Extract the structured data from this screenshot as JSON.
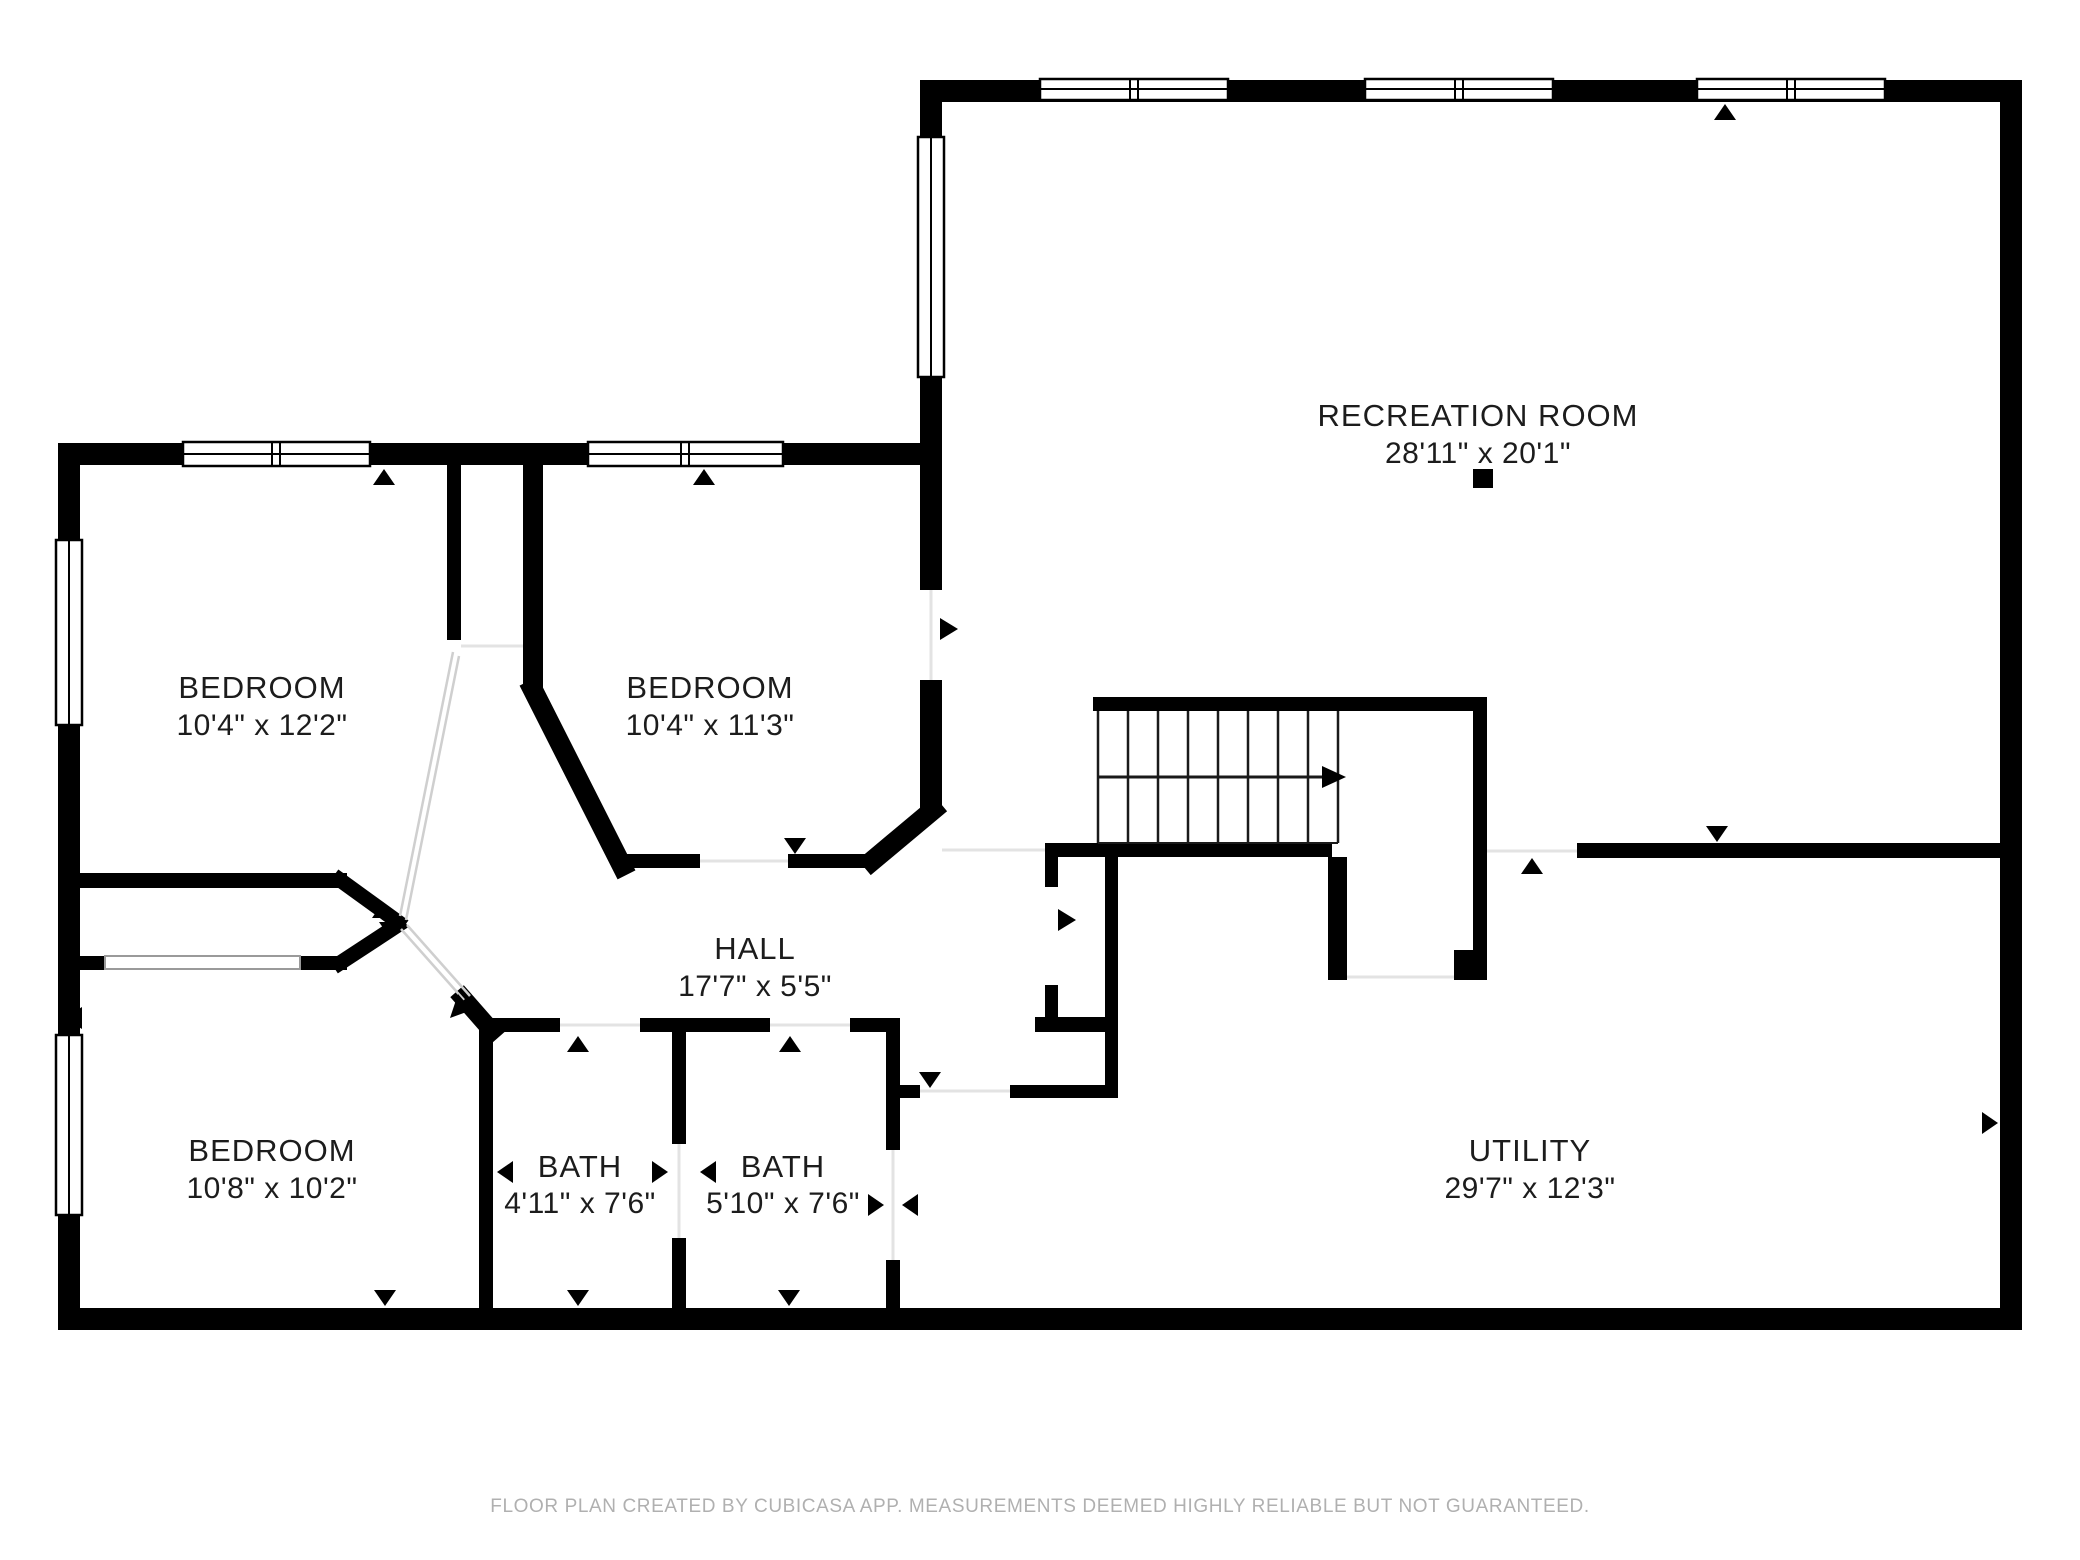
{
  "page": {
    "background": "#ffffff"
  },
  "plan": {
    "wall_color": "#000000",
    "text_color": "#1c1c1c",
    "rooms": [
      {
        "id": "recreation-room",
        "name": "RECREATION ROOM",
        "dimensions": "28'11\" x 20'1\""
      },
      {
        "id": "bedroom-top-left",
        "name": "BEDROOM",
        "dimensions": "10'4\" x 12'2\""
      },
      {
        "id": "bedroom-top-center",
        "name": "BEDROOM",
        "dimensions": "10'4\" x 11'3\""
      },
      {
        "id": "hall",
        "name": "HALL",
        "dimensions": "17'7\" x 5'5\""
      },
      {
        "id": "bedroom-bottom-left",
        "name": "BEDROOM",
        "dimensions": "10'8\" x 10'2\""
      },
      {
        "id": "bath-left",
        "name": "BATH",
        "dimensions": "4'11\" x 7'6\""
      },
      {
        "id": "bath-right",
        "name": "BATH",
        "dimensions": "5'10\" x 7'6\""
      },
      {
        "id": "utility",
        "name": "UTILITY",
        "dimensions": "29'7\" x 12'3\""
      }
    ],
    "stairs": {
      "direction": "right",
      "tread_count": 8
    }
  },
  "footer": {
    "text": "FLOOR PLAN CREATED BY CUBICASA APP. MEASUREMENTS DEEMED HIGHLY RELIABLE BUT NOT GUARANTEED.",
    "color": "#b0b0b0"
  }
}
